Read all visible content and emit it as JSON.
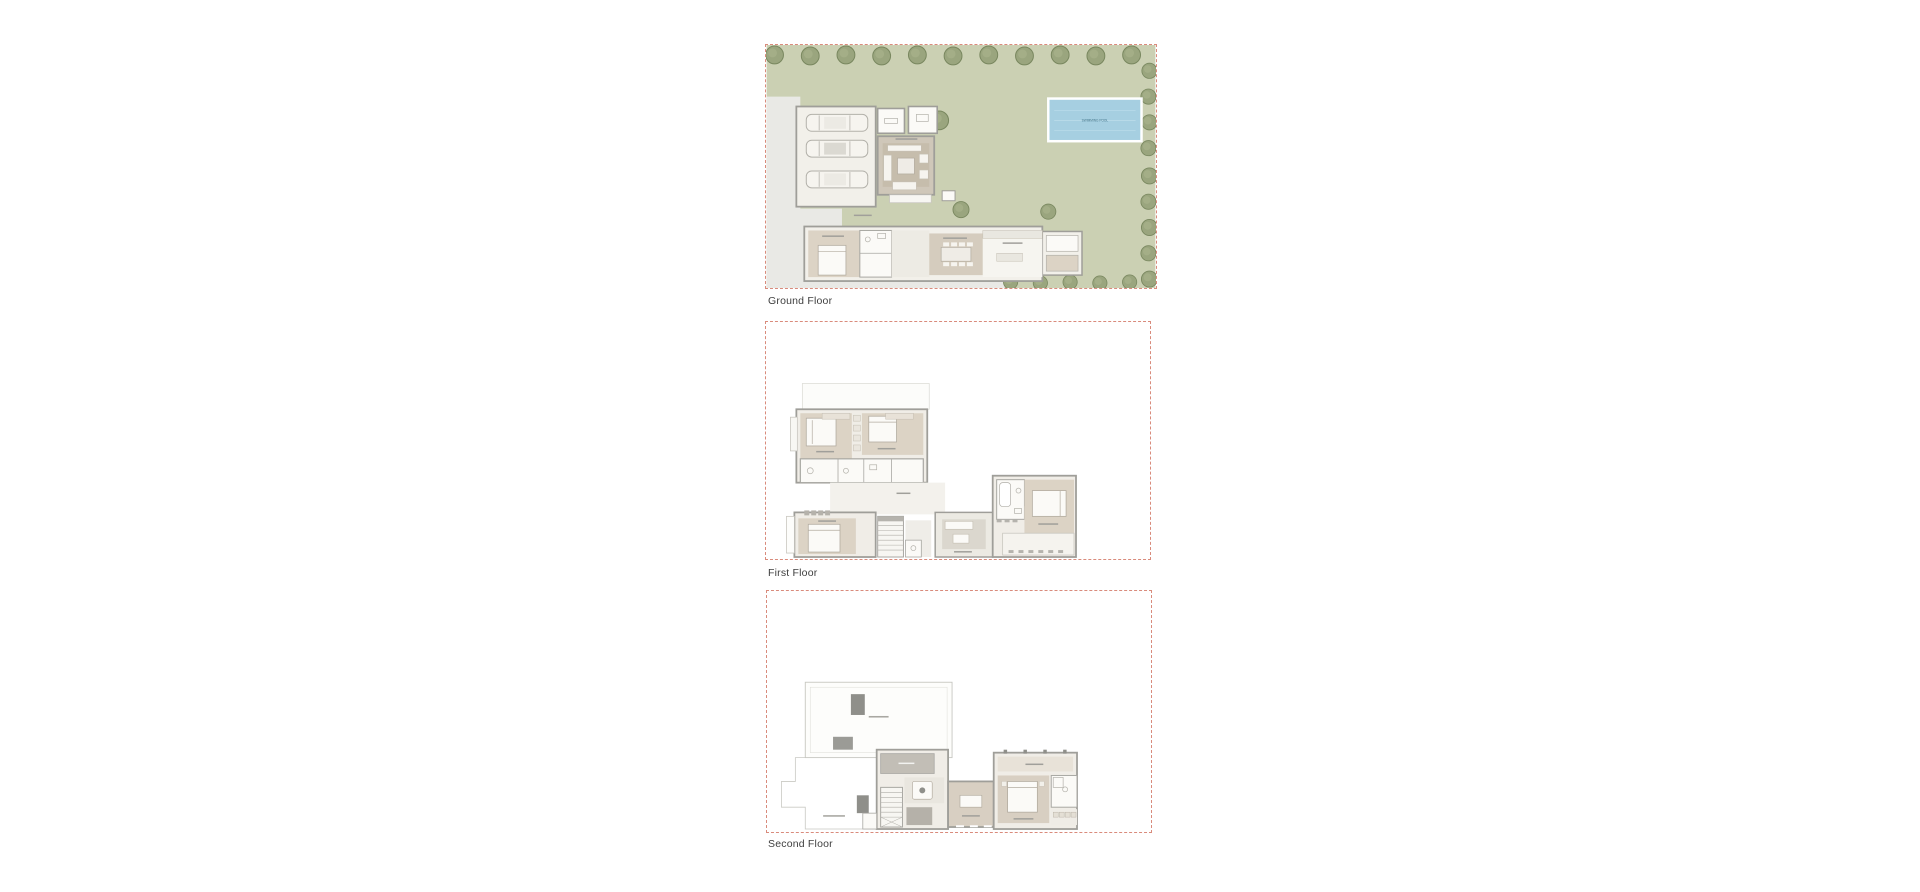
{
  "page": {
    "background": "#ffffff"
  },
  "floors": [
    {
      "id": "ground-floor",
      "label": "Ground Floor"
    },
    {
      "id": "first-floor",
      "label": "First Floor"
    },
    {
      "id": "second-floor",
      "label": "Second Floor"
    }
  ],
  "ground_floor": {
    "pool_label": "SWIMMING POOL",
    "garage_car_count": "3"
  },
  "colors": {
    "boundary_dash": "#d98b7c",
    "lawn": "#cbd0b3",
    "tree": "#9aa57e",
    "tree_outline": "#79875f",
    "pool_water": "#a6cfe1",
    "pool_border": "#ffffff",
    "pool_text": "#3e7186",
    "wall": "#9f9e99",
    "floor_light": "#f1efe9",
    "floor_beige": "#dcd3c5",
    "paving": "#e9e9e5",
    "caption_text": "#3e3e3e"
  }
}
